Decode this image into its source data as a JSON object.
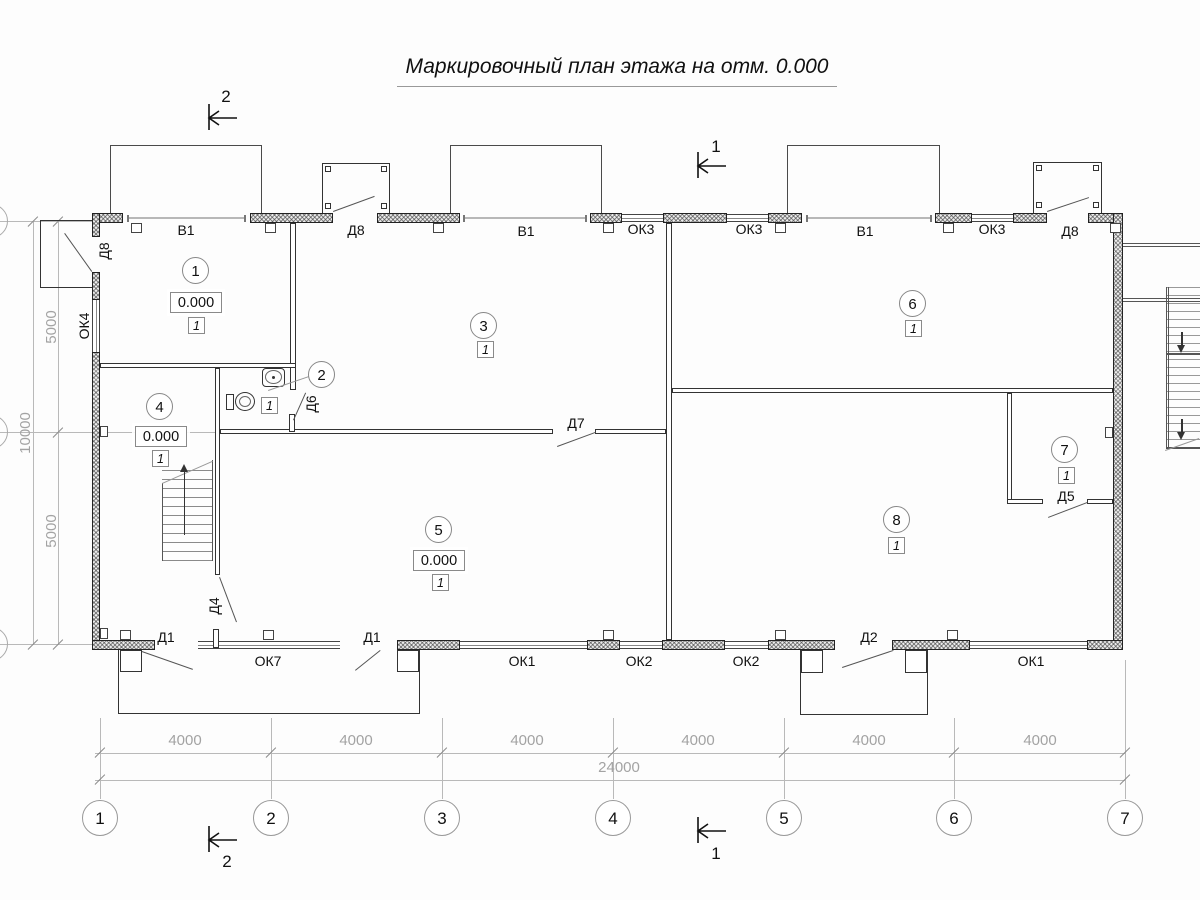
{
  "drawing": {
    "title": "Маркировочный план этажа на отм. 0.000"
  },
  "rooms": [
    {
      "number": "1",
      "elevation": "0.000",
      "finish_type": "1"
    },
    {
      "number": "2",
      "finish_type": "1"
    },
    {
      "number": "3",
      "finish_type": "1"
    },
    {
      "number": "4",
      "elevation": "0.000",
      "finish_type": "1"
    },
    {
      "number": "5",
      "elevation": "0.000",
      "finish_type": "1"
    },
    {
      "number": "6",
      "finish_type": "1"
    },
    {
      "number": "7",
      "finish_type": "1"
    },
    {
      "number": "8",
      "finish_type": "1"
    }
  ],
  "labels": {
    "top": [
      "В1",
      "Д8",
      "В1",
      "ОК3",
      "ОК3",
      "В1",
      "ОК3",
      "Д8"
    ],
    "left_wall": [
      "Д8",
      "ОК4"
    ],
    "bottom": [
      "Д1",
      "ОК7",
      "Д1",
      "ОК1",
      "ОК2",
      "ОК2",
      "Д2",
      "ОК1"
    ],
    "interior": {
      "d6": "Д6",
      "d4": "Д4",
      "d7": "Д7",
      "d5": "Д5"
    }
  },
  "dimensions": {
    "bottom_segments": [
      "4000",
      "4000",
      "4000",
      "4000",
      "4000",
      "4000"
    ],
    "bottom_total": "24000",
    "left_segments": [
      "5000",
      "10000",
      "5000"
    ]
  },
  "axes": {
    "columns": [
      "1",
      "2",
      "3",
      "4",
      "5",
      "6",
      "7"
    ]
  },
  "section_marks": {
    "top_left": "2",
    "top_right": "1",
    "bottom_left": "2",
    "bottom_right": "1"
  },
  "colors": {
    "line": "#2b2b2b",
    "dim_gray": "#a3a3a3",
    "window_gray": "#b8b8b8"
  }
}
